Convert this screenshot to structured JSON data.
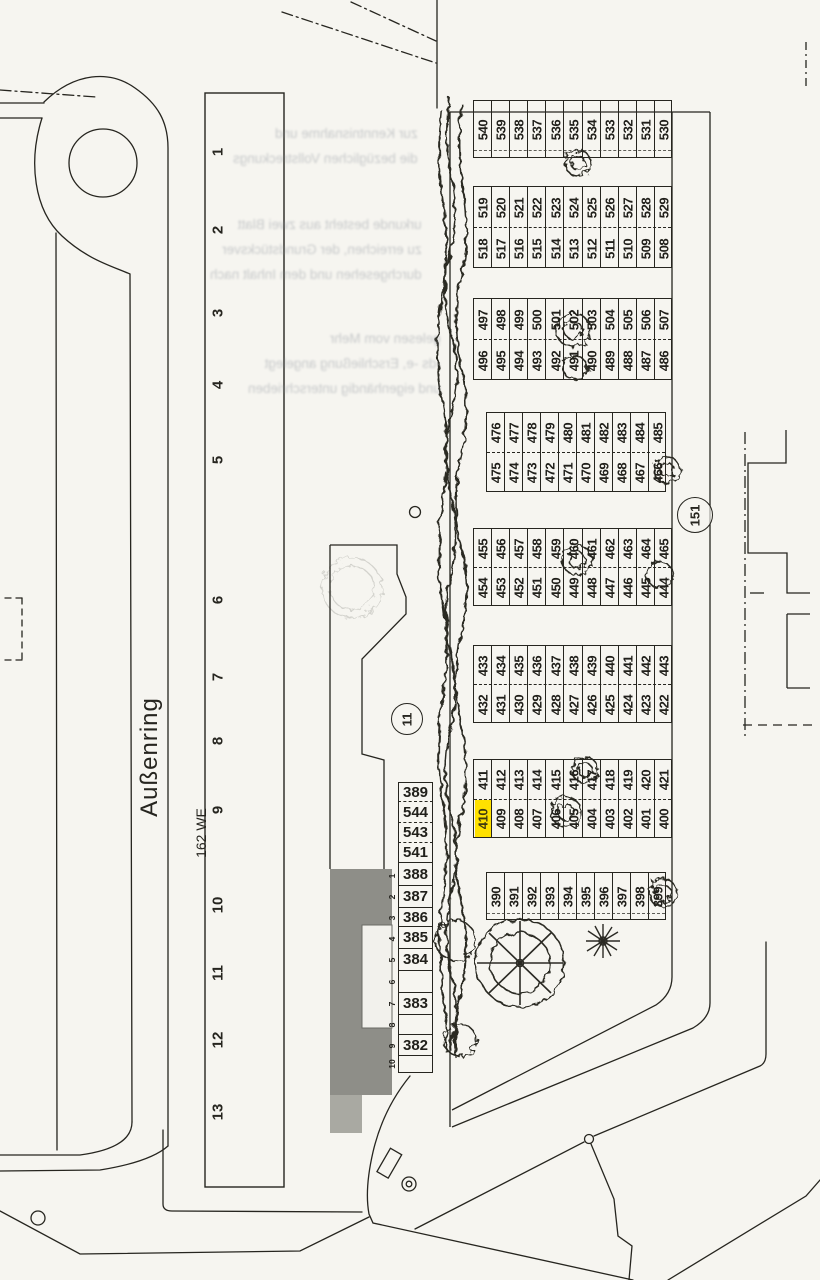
{
  "street": {
    "name": "Außenring"
  },
  "area_label": "162 WE",
  "circled_labels": {
    "inner_court": "11",
    "road_parcel": "151"
  },
  "building_units": [
    "1",
    "2",
    "3",
    "4",
    "5",
    "6",
    "7",
    "8",
    "9",
    "10",
    "11",
    "12",
    "13"
  ],
  "column_ticks": [
    "1",
    "2",
    "3",
    "4",
    "5",
    "6",
    "7",
    "8",
    "9",
    "10"
  ],
  "parking": {
    "highlighted": "410",
    "highlight_color": "#FFE100",
    "bands": [
      {
        "rows": [
          [
            "540",
            "539",
            "538",
            "537",
            "536",
            "535",
            "534",
            "533",
            "532",
            "531",
            "530"
          ]
        ]
      },
      {
        "rows": [
          [
            "519",
            "520",
            "521",
            "522",
            "523",
            "524",
            "525",
            "526",
            "527",
            "528",
            "529"
          ],
          [
            "518",
            "517",
            "516",
            "515",
            "514",
            "513",
            "512",
            "511",
            "510",
            "509",
            "508"
          ]
        ]
      },
      {
        "rows": [
          [
            "497",
            "498",
            "499",
            "500",
            "501",
            "502",
            "503",
            "504",
            "505",
            "506",
            "507"
          ],
          [
            "496",
            "495",
            "494",
            "493",
            "492",
            "491",
            "490",
            "489",
            "488",
            "487",
            "486"
          ]
        ]
      },
      {
        "rows": [
          [
            "476",
            "477",
            "478",
            "479",
            "480",
            "481",
            "482",
            "483",
            "484",
            "485"
          ],
          [
            "475",
            "474",
            "473",
            "472",
            "471",
            "470",
            "469",
            "468",
            "467",
            "466"
          ]
        ]
      },
      {
        "rows": [
          [
            "455",
            "456",
            "457",
            "458",
            "459",
            "460",
            "461",
            "462",
            "463",
            "464",
            "465"
          ],
          [
            "454",
            "453",
            "452",
            "451",
            "450",
            "449",
            "448",
            "447",
            "446",
            "445",
            "444"
          ]
        ]
      },
      {
        "rows": [
          [
            "433",
            "434",
            "435",
            "436",
            "437",
            "438",
            "439",
            "440",
            "441",
            "442",
            "443"
          ],
          [
            "432",
            "431",
            "430",
            "429",
            "428",
            "427",
            "426",
            "425",
            "424",
            "423",
            "422"
          ]
        ]
      },
      {
        "rows": [
          [
            "411",
            "412",
            "413",
            "414",
            "415",
            "416",
            "417",
            "418",
            "419",
            "420",
            "421"
          ],
          [
            "410",
            "409",
            "408",
            "407",
            "406",
            "405",
            "404",
            "403",
            "402",
            "401",
            "400"
          ]
        ]
      },
      {
        "rows": [
          [
            "390",
            "391",
            "392",
            "393",
            "394",
            "395",
            "396",
            "397",
            "398",
            "399"
          ]
        ]
      }
    ],
    "side_column": [
      "389",
      "544",
      "543",
      "541",
      "388",
      "387",
      "386",
      "385",
      "384",
      "",
      "383",
      "",
      "382",
      ""
    ]
  },
  "ghost_text": {
    "block1": [
      "zur Kenntnisnahme und",
      "die bezüglichen Vollstreckungs"
    ],
    "block2": [
      "urkunde besteht aus zwei Blatt",
      "zu erreichen, der Grundstücksver",
      "durchgesehen und dem Inhalt nach"
    ],
    "block3": [
      "gelesen vom Mehr",
      "-ds -e, Erschließung angelegt",
      "und eigenhändig unterschrieben"
    ]
  },
  "colors": {
    "ink": "#26251f",
    "paper": "#f6f5f0",
    "building_fill": "#8e8e88"
  }
}
